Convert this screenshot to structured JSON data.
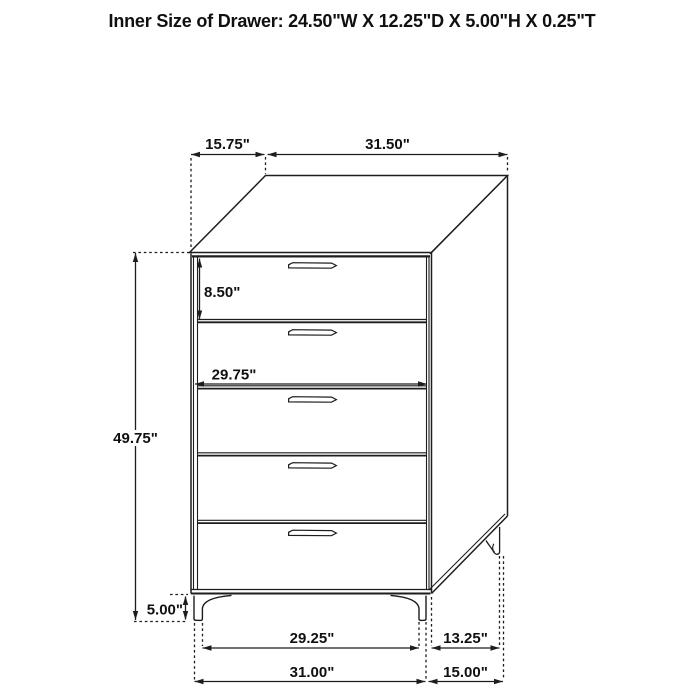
{
  "title": "Inner Size of Drawer: 24.50\"W X 12.25\"D X 5.00\"H X 0.25\"T",
  "figure": {
    "name": "five-drawer-chest-dimension-line-drawing",
    "drawer_count": 5
  },
  "dims": {
    "top_depth": "15.75\"",
    "top_width": "31.50\"",
    "first_drawer_height": "8.50\"",
    "drawer_width": "29.75\"",
    "overall_height": "49.75\"",
    "leg_height": "5.00\"",
    "front_legs_inner_span": "29.25\"",
    "side_legs_span": "13.25\"",
    "base_front_width": "31.00\"",
    "base_side_depth": "15.00\""
  }
}
